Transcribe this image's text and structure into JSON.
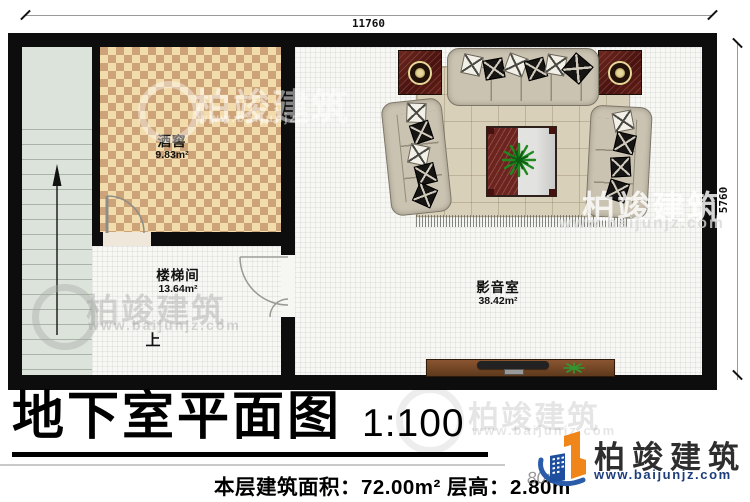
{
  "dimensions": {
    "width_label": "11760",
    "height_label": "5760"
  },
  "rooms": {
    "wine_cellar": {
      "name": "酒窖",
      "area": "9.83m²"
    },
    "stairwell": {
      "name": "楼梯间",
      "area": "13.64m²"
    },
    "media_room": {
      "name": "影音室",
      "area": "38.42m²"
    }
  },
  "stairs": {
    "direction_label": "上"
  },
  "title_block": {
    "title": "地下室平面图",
    "scale": "1:100",
    "floor_info": "本层建筑面积：72.00m² 层高：2.80m"
  },
  "brand": {
    "name": "柏竣建筑",
    "website": "www.baijunjz.com"
  },
  "watermarks": {
    "name": "柏竣建筑",
    "website": "www.baijunjz.com",
    "partial_text": "80m"
  },
  "colors": {
    "wall": "#0d0d0d",
    "tile_light": "#f2dcab",
    "tile_dark": "#cda47a",
    "stairs_floor": "#dce3da",
    "room_floor": "#f7f7f4",
    "rug": "#d9d0ba",
    "sofa": "#cbc3b1",
    "speaker_maroon": "#5c1b15",
    "table_maroon": "#6e241e",
    "cabinet_wood": "#7b4a28",
    "brand_blue": "#1d3d7a",
    "brand_orange": "#f08519"
  }
}
